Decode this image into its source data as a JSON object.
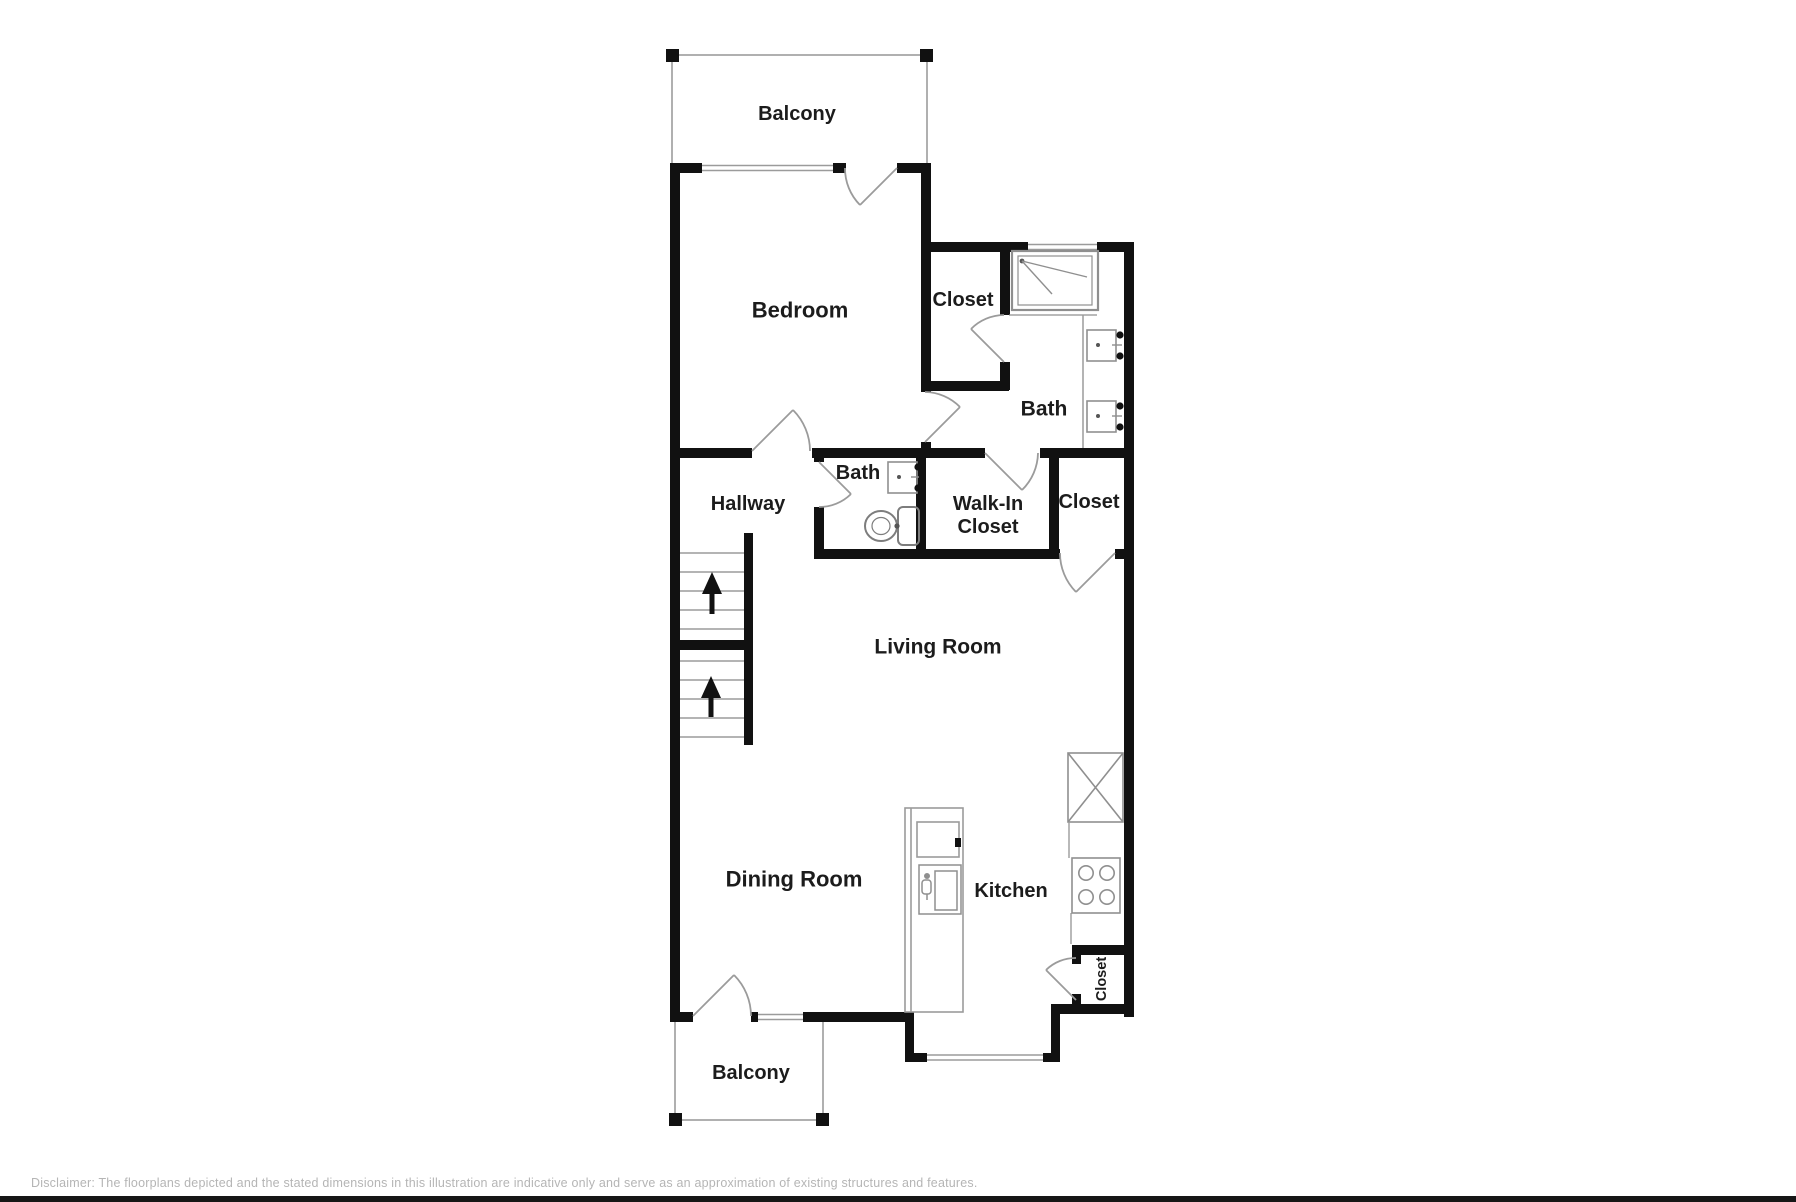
{
  "colors": {
    "wall": "#111111",
    "thin_line": "#9b9b9b",
    "balcony_line": "#b0b0b0",
    "fixture_line": "#8f8f8f",
    "label_text": "#1c1c1c",
    "disclaimer_text": "#b5b5b5",
    "background": "#ffffff"
  },
  "rooms": {
    "balcony_top": "Balcony",
    "bedroom": "Bedroom",
    "closet_top": "Closet",
    "bath_top": "Bath",
    "hallway": "Hallway",
    "bath_mid": "Bath",
    "walk_in_closet_line1": "Walk-In",
    "walk_in_closet_line2": "Closet",
    "closet_mid": "Closet",
    "living_room": "Living Room",
    "dining_room": "Dining Room",
    "kitchen": "Kitchen",
    "closet_small": "Closet",
    "balcony_bottom": "Balcony"
  },
  "footer": {
    "disclaimer": "Disclaimer: The floorplans depicted and the stated dimensions in this illustration are indicative only and serve as an approximation of existing structures and features."
  }
}
